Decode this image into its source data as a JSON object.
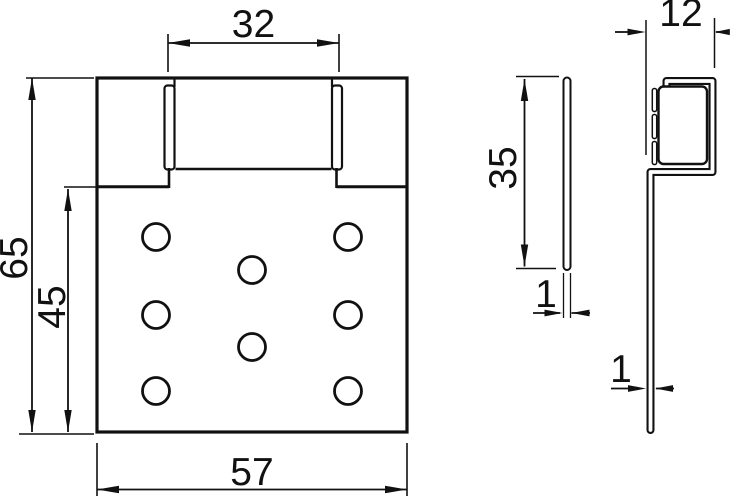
{
  "drawing": {
    "background": "#ffffff",
    "line_color": "#111111",
    "views": {
      "front": {
        "name": "front view of perforated mounting plate",
        "dimensions": {
          "tab_width": "32",
          "total_height": "65",
          "plate_height": "45",
          "total_width": "57"
        },
        "hole_count": 8
      },
      "side_plate": {
        "name": "side view of flat plate",
        "dimensions": {
          "height": "35",
          "thickness": "1"
        }
      },
      "side_bracket": {
        "name": "side view of hook bracket profile",
        "dimensions": {
          "width": "12",
          "thickness": "1"
        }
      }
    }
  }
}
